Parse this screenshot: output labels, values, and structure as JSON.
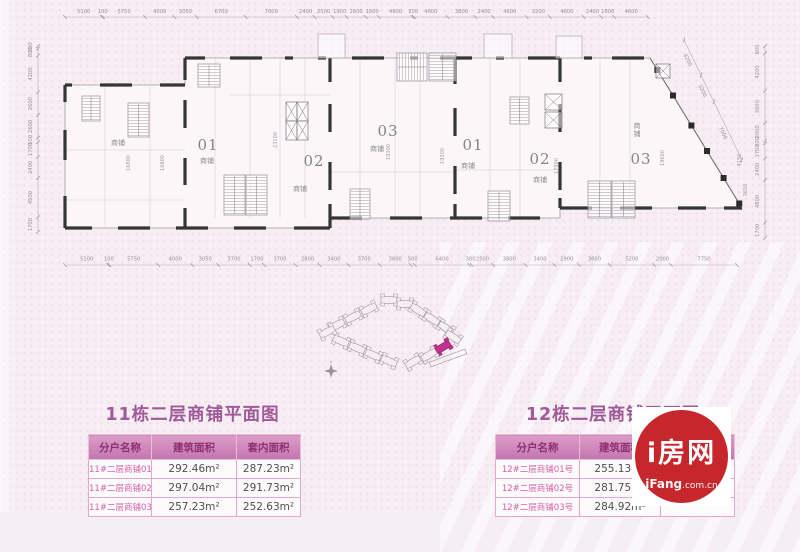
{
  "colors": {
    "background": "#f7eef4",
    "accent_pink": "#c276ae",
    "title_pink": "#a05a98",
    "logo_red": "#c5272d",
    "site_highlight": "#c0348e"
  },
  "floorplan": {
    "top_dims": [
      "5100",
      "100",
      "5750",
      "4000",
      "3050",
      "6700",
      "7000",
      "2400",
      "2500",
      "1900",
      "2600",
      "1800",
      "4600",
      "200",
      "4600",
      "3800",
      "2400",
      "4600",
      "3200",
      "4600",
      "2400",
      "1800",
      "4600"
    ],
    "bottom_dims": [
      "5100",
      "100",
      "5750",
      "4000",
      "3050",
      "3700",
      "1700",
      "3700",
      "2800",
      "3400",
      "3700",
      "3600",
      "500",
      "6400",
      "300",
      "2500",
      "3800",
      "3400",
      "2900",
      "3600",
      "5200",
      "2000",
      "7750"
    ],
    "left_dims": [
      "300",
      "800",
      "4200",
      "2600",
      "2600",
      "500",
      "1700",
      "2400",
      "4500",
      "1700"
    ],
    "right_dims": [
      "800",
      "4200",
      "3600",
      "2000",
      "300",
      "1700",
      "2400",
      "4800",
      "1700"
    ],
    "diag_dims": [
      "4200",
      "3200",
      "7000"
    ],
    "shop_label": "商铺",
    "units": [
      {
        "x": 208,
        "y": 150,
        "t": "01"
      },
      {
        "x": 314,
        "y": 166,
        "t": "02"
      },
      {
        "x": 388,
        "y": 136,
        "t": "03"
      },
      {
        "x": 473,
        "y": 150,
        "t": "01"
      },
      {
        "x": 540,
        "y": 164,
        "t": "02"
      },
      {
        "x": 641,
        "y": 164,
        "t": "03"
      }
    ],
    "shops": [
      {
        "x": 118,
        "y": 145
      },
      {
        "x": 207,
        "y": 163
      },
      {
        "x": 300,
        "y": 191
      },
      {
        "x": 377,
        "y": 151
      },
      {
        "x": 468,
        "y": 168
      },
      {
        "x": 540,
        "y": 182
      },
      {
        "x": 637,
        "y": 128,
        "vert": true
      }
    ],
    "inner_dims": [
      {
        "x": 130,
        "y": 163,
        "t": "16800"
      },
      {
        "x": 164,
        "y": 163,
        "t": "16800"
      },
      {
        "x": 277,
        "y": 140,
        "t": "23100"
      },
      {
        "x": 390,
        "y": 152,
        "t": "19300"
      },
      {
        "x": 444,
        "y": 156,
        "t": "19300"
      },
      {
        "x": 558,
        "y": 166,
        "t": "17900"
      },
      {
        "x": 664,
        "y": 158,
        "t": "19600"
      },
      {
        "x": 741,
        "y": 160,
        "t": "4150"
      },
      {
        "x": 747,
        "y": 190,
        "t": "3650"
      }
    ]
  },
  "siteplan": {
    "highlight_color": "#c0348e"
  },
  "sections": [
    {
      "title": "11栋二层商铺平面图",
      "headers": [
        "分户名称",
        "建筑面积",
        "套内面积"
      ],
      "rows": [
        [
          "11#二层商铺01号",
          "292.46m²",
          "287.23m²"
        ],
        [
          "11#二层商铺02号",
          "297.04m²",
          "291.73m²"
        ],
        [
          "11#二层商铺03号",
          "257.23m²",
          "252.63m²"
        ]
      ]
    },
    {
      "title": "12栋二层商铺平面图",
      "headers": [
        "分户名称",
        "建筑面积",
        "套内面积"
      ],
      "rows": [
        [
          "12#二层商铺01号",
          "255.13m²",
          ""
        ],
        [
          "12#二层商铺02号",
          "281.75m²",
          ""
        ],
        [
          "12#二层商铺03号",
          "284.92m²",
          ""
        ]
      ]
    }
  ],
  "logo": {
    "title": "i房网",
    "domain_bold": "iFang",
    "domain_rest": ".com.cn"
  }
}
